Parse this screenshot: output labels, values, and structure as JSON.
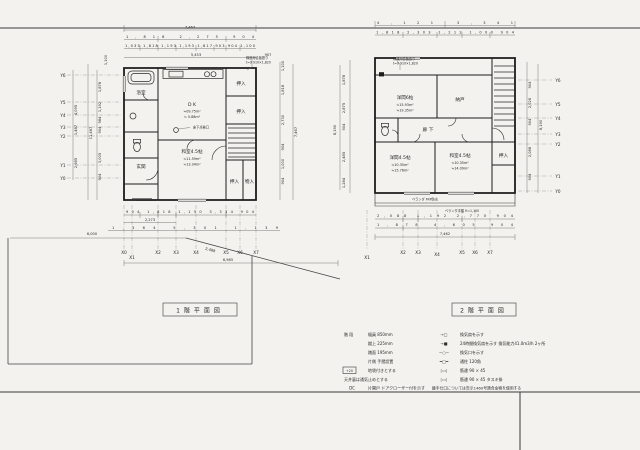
{
  "sheet": {
    "titles": {
      "plan1": "1階平面図",
      "plan2": "2階平面図"
    }
  },
  "plan1": {
    "dims": {
      "t1": "7,467",
      "t2": "1,818 2,275 904",
      "t3": "1,033 1,818 1,193 1,193 1,817 903 904 1,100",
      "t4a": "5,453",
      "t4b": "907",
      "left_a": [
        "1,100",
        "4,095",
        "1,487",
        "2,985"
      ],
      "left_total": "11,467",
      "left_b": [
        "1,878",
        "1,192",
        "984",
        "904",
        "3,005",
        "904"
      ],
      "right_a": [
        "1,100",
        "1,818",
        "2,730",
        "904",
        "1,000",
        "904"
      ],
      "right_total": "7,467",
      "b1": "904 1,818 1,150 3,334 904",
      "b2": "2,273",
      "b3": "1,364 5,301 1,139",
      "b4": "6,985",
      "site_w": "6,000",
      "site_d": "2,488"
    },
    "xLabels": [
      "X0",
      "X1",
      "X2",
      "X3",
      "X4",
      "X5",
      "X6",
      "X7"
    ],
    "yLabels": [
      "Y6",
      "Y5",
      "Y4",
      "Y3",
      "Y2",
      "Y1",
      "Y0"
    ],
    "rooms": {
      "bath": "浴室",
      "entrance": "玄関",
      "dk": "D K",
      "dk_area1": "≒09.75m²",
      "dk_area2": "≒ 5.88m²",
      "washitsu": "和室4.5帖",
      "washitsu_area1": "≒11.59m²",
      "washitsu_area2": "≒13.34m²",
      "oshiire1": "押入",
      "oshiire2": "押入",
      "oshiire3": "押入",
      "monoire": "物入",
      "tenkenkou": "床下点検口",
      "note1": "構造用合板張り",
      "note2": "t=9 910×1,820"
    }
  },
  "plan2": {
    "dims": {
      "t1": "4,121 3,341",
      "t2": "1,818 2,303 1,212 1,000 904",
      "left_a": [
        "1,878",
        "2,875",
        "904",
        "2,485",
        "1,284"
      ],
      "left_total": "8,190",
      "right_a": [
        "904",
        "2,026",
        "904",
        "2,088",
        "904"
      ],
      "right_total": "8,190",
      "b1": "2,088 1,192 2,770 904",
      "b2": "1,878 4,605 904",
      "b3": "7,462"
    },
    "xLabels": [
      "X1",
      "X2",
      "X3",
      "X4",
      "X5",
      "X6",
      "X7"
    ],
    "yLabels": [
      "Y6",
      "Y5",
      "Y4",
      "Y3",
      "Y2",
      "Y1",
      "Y0"
    ],
    "rooms": {
      "yoma6": "洋間6帖",
      "yoma6_area1": "≒15.93m²",
      "yoma6_area2": "≒19.35m²",
      "nando": "納戸",
      "rouka": "廊 下",
      "yoma45": "洋間4.5帖",
      "yoma45_area1": "≒10.35m²",
      "yoma45_area2": "≒15.76m²",
      "washitsu45": "和室4.5帖",
      "washitsu45_area1": "≒10.35m²",
      "washitsu45_area2": "≒14.09m²",
      "oshiire_right": "押入",
      "veranda": "ベランダ FRP防水",
      "veranda_rail": "ベランダ手摺 H=1,100",
      "note1": "構造用合板張り",
      "note2": "t=9 910×1,820"
    }
  },
  "legend": {
    "left": {
      "title": "階 段",
      "r1": "幅員 850mm",
      "r2": "蹴上 225mm",
      "r3": "踏面 195mm",
      "r4": "片側 手摺設置",
      "sym5": "+20",
      "r5": "地袋付きとする",
      "r6": "天井裏は通気止めとする",
      "sym7": "DC",
      "r7": "片開戸 ドアクローザー付を示す"
    },
    "right": {
      "rows": [
        {
          "sym": "→□",
          "text": "換気扇を示す"
        },
        {
          "sym": "→■",
          "text": "24時間換気扇を示す 換気能力41.0m3/h 2ヶ所"
        },
        {
          "sym": "−○−",
          "text": "換気口を示す"
        },
        {
          "sym": "═□═",
          "text": "通柱 120角"
        },
        {
          "sym": "▷◁",
          "text": "筋違 90 × 45"
        },
        {
          "sym": "▷◁",
          "text": "筋違 90 × 45 タスキ掛"
        }
      ],
      "note": "継手仕口については告示1460号適合金物を使用する"
    }
  }
}
